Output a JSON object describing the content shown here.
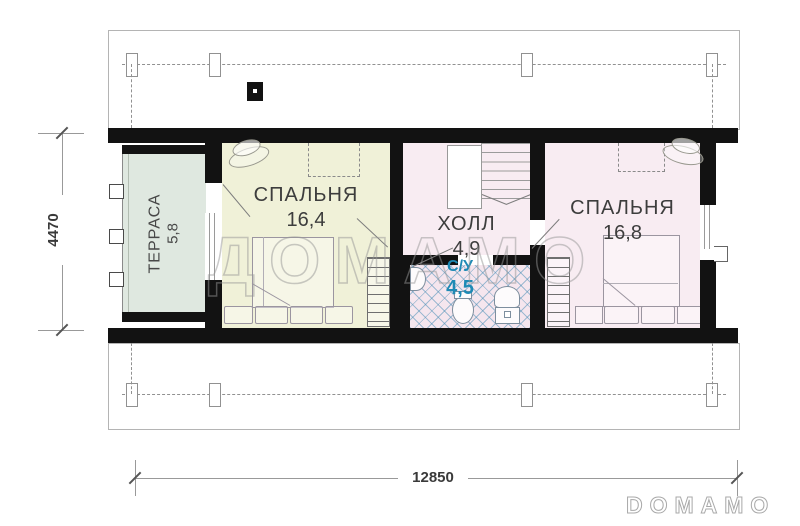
{
  "watermark_text": "ДОМАМО",
  "brand_logo_text": "DOMAMO",
  "rooms": {
    "terrace": {
      "label": "ТЕРРАСА",
      "area": "5,8",
      "fill": "#dfe8e0"
    },
    "bedroom1": {
      "label": "СПАЛЬНЯ",
      "area": "16,4",
      "fill": "#f0f1d8"
    },
    "hall": {
      "label": "ХОЛЛ",
      "area": "4,9",
      "fill": "#f8ecf2"
    },
    "bathroom": {
      "label": "С/У",
      "area": "4,5",
      "fill": "#f5e6ee",
      "label_color": "#1e8ab5"
    },
    "bedroom2": {
      "label": "СПАЛЬНЯ",
      "area": "16,8",
      "fill": "#f8ecf2"
    }
  },
  "dimensions": {
    "overall_width": "12850",
    "overall_depth": "4470"
  },
  "colors": {
    "wall": "#121212",
    "roof_line": "#9a9a9a",
    "tile_accent": "#4f8cb4",
    "dim_text": "#3a3a3a"
  }
}
